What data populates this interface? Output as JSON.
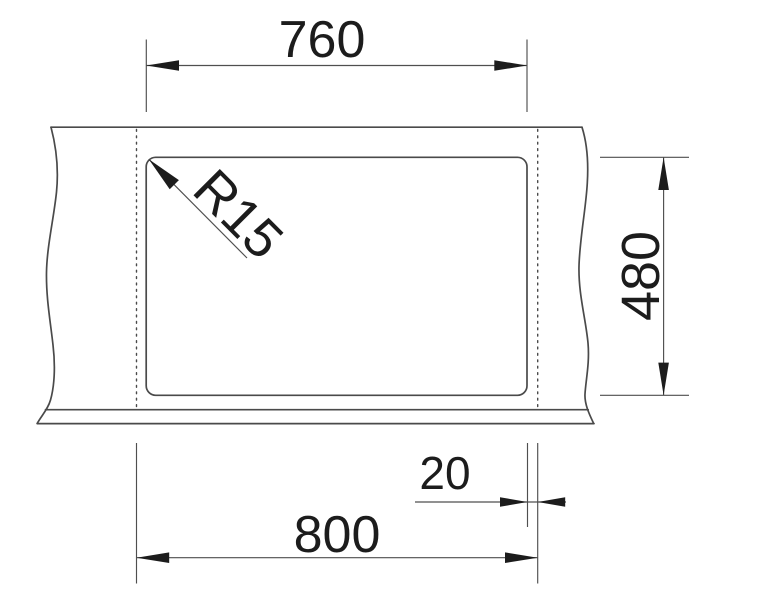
{
  "drawing": {
    "title": "Sink cutout installation drawing",
    "labels": {
      "cutout_width": "760",
      "cutout_height": "480",
      "overall_width": "800",
      "edge_offset": "20",
      "corner_radius": "R15"
    },
    "values": {
      "cutout_width_mm": 760,
      "cutout_height_mm": 480,
      "overall_width_mm": 800,
      "edge_offset_mm": 20,
      "corner_radius_mm": 15
    },
    "colors": {
      "background": "#ffffff",
      "outline": "#4a4a4a",
      "dimension": "#4f4f4f",
      "text": "#1c1c1c"
    }
  }
}
